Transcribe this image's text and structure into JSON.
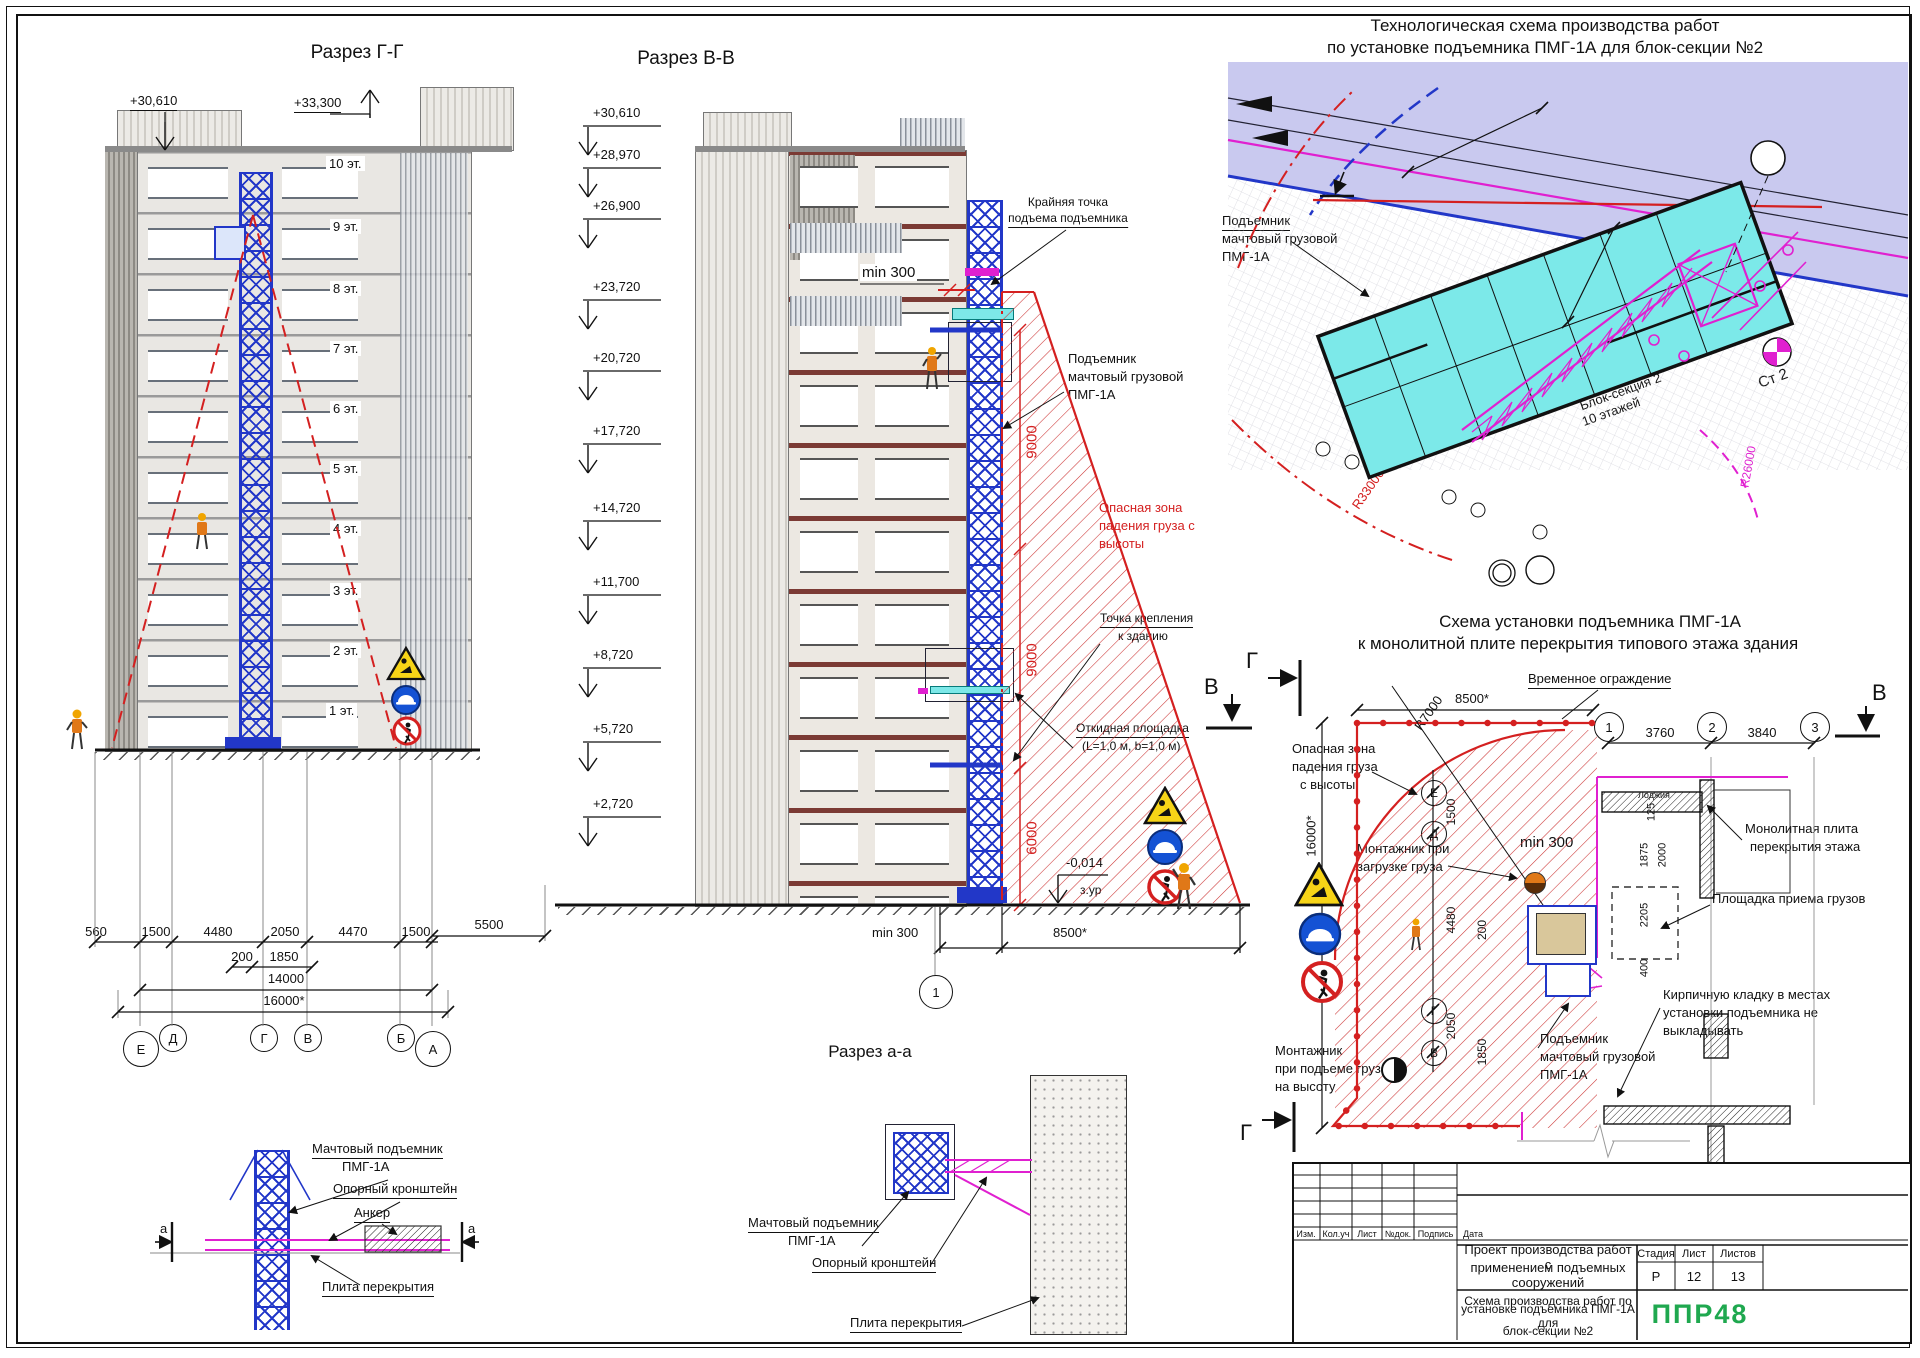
{
  "gg": {
    "title": "Разрез Г-Г",
    "elev_roof": "+30,610",
    "elev_top": "+33,300",
    "floors": [
      "10 эт.",
      "9 эт.",
      "8 эт.",
      "7 эт.",
      "6 эт.",
      "5 эт.",
      "4 эт.",
      "3 эт.",
      "2 эт.",
      "1 эт."
    ],
    "dims": [
      "560",
      "1500",
      "4480",
      "2050",
      "4470",
      "1500"
    ],
    "dim_5500": "5500",
    "dim_200": "200",
    "dim_1850": "1850",
    "dim_14000": "14000",
    "dim_16000": "16000*",
    "axes": [
      "Е",
      "Д",
      "Г",
      "В",
      "Б",
      "А"
    ]
  },
  "levels": [
    "+30,610",
    "+28,970",
    "+26,900",
    "+23,720",
    "+20,720",
    "+17,720",
    "+14,720",
    "+11,700",
    "+8,720",
    "+5,720",
    "+2,720"
  ],
  "vv": {
    "title": "Разрез В-В",
    "top_point_1": "Крайняя точка",
    "top_point_2": "подъема подъемника",
    "min300_top": "min 300",
    "hoist_1": "Подъемник",
    "hoist_2": "мачтовый грузовой",
    "hoist_3": "ПМГ-1А",
    "danger_1": "Опасная зона",
    "danger_2": "падения груза с",
    "danger_3": "высоты",
    "attach_1": "Точка крепления",
    "attach_2": "к зданию",
    "platform_1": "Откидная площадка",
    "platform_2": "(L=1,0 м, b=1,0 м)",
    "dim_9000a": "9000",
    "dim_9000b": "9000",
    "dim_6000": "6000",
    "level_ground": "-0,014",
    "level_ground2": "з.ур",
    "min300_bottom": "min 300",
    "dim_8500": "8500*",
    "axis_1": "1"
  },
  "site": {
    "title_1": "Технологическая схема производства работ",
    "title_2": "по установке подъемника ПМГ-1А для блок-секции №2",
    "crane_1": "Башенный кран",
    "crane_2": "КБ 401",
    "bubble_10": "10",
    "hoist_1": "Подъемник",
    "hoist_2": "мачтовый грузовой",
    "hoist_3": "ПМГ-1А",
    "r33000_a": "R33000",
    "r33000_b": "R33000",
    "dim_12000": "12000",
    "dim_6000": "6000",
    "r25000": "R25000",
    "r26000": "R26000",
    "block_1": "Блок-секция 2",
    "block_2": "10 этажей",
    "stand": "Ст 2",
    "marker_b": "В",
    "bubble_1": "1"
  },
  "ip": {
    "title_1": "Схема установки подъемника ПМГ-1А",
    "title_2": "к монолитной плите перекрытия типового этажа здания",
    "fence": "Временное ограждение",
    "dim_8500": "8500*",
    "r7000": "R7000",
    "danger_1": "Опасная зона",
    "danger_2": "падения груза",
    "danger_3": "с высоты",
    "dim_16000": "16000*",
    "loader_1": "Монтажник при",
    "loader_2": "загрузке груза",
    "min300": "min 300",
    "lifter_1": "Монтажник",
    "lifter_2": "при подъеме груза",
    "lifter_3": "на высоту",
    "hoist_1": "Подъемник",
    "hoist_2": "мачтовый грузовой",
    "hoist_3": "ПМГ-1А",
    "slab_1": "Монолитная плита",
    "slab_2": "перекрытия этажа",
    "recv": "Площадка приема грузов",
    "brick_1": "Кирпичную кладку в местах",
    "brick_2": "установки подъемника не",
    "brick_3": "выкладывать",
    "loggia": "Лоджия",
    "axes": [
      "Е",
      "Д",
      "Г",
      "В"
    ],
    "vdims": [
      "1500",
      "4480",
      "200",
      "2050",
      "1850"
    ],
    "cols": [
      "1",
      "2",
      "3"
    ],
    "dim_3760": "3760",
    "dim_3840": "3840",
    "sdims": [
      "125",
      "1875",
      "2000",
      "2205",
      "400"
    ],
    "marker_g": "Г",
    "marker_v": "В"
  },
  "dl": {
    "mast_1": "Мачтовый подъемник",
    "mast_2": "ПМГ-1А",
    "bracket": "Опорный кронштейн",
    "anchor": "Анкер",
    "slab": "Плита перекрытия",
    "mark_a": "a"
  },
  "aa": {
    "title": "Разрез а-а",
    "mast_1": "Мачтовый подъемник",
    "mast_2": "ПМГ-1А",
    "bracket": "Опорный кронштейн",
    "slab": "Плита перекрытия"
  },
  "tb": {
    "cols": [
      "Изм.",
      "Кол.уч",
      "Лист",
      "№док.",
      "Подпись",
      "Дата"
    ],
    "project_1": "Проект производства работ с",
    "project_2": "применением подъемных сооружений",
    "stage_h": "Стадия",
    "sheet_h": "Лист",
    "sheets_h": "Листов",
    "stage": "Р",
    "sheet": "12",
    "sheets": "13",
    "draw_1": "Схема производства работ по",
    "draw_2": "установке подъемника ПМГ-1А для",
    "draw_3": "блок-секции №2",
    "logo": "ППР48"
  }
}
